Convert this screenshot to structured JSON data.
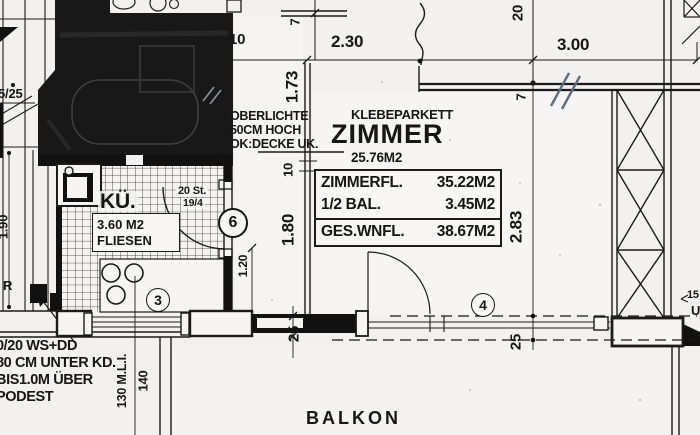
{
  "colors": {
    "ink": "#1b1b1b",
    "paper": "#f2f1ef",
    "pencil_blue": "#5d6c80"
  },
  "rooms": {
    "zimmer": {
      "name": "ZIMMER",
      "area": "25.76M2",
      "floor": "KLEBEPARKETT"
    },
    "kueche": {
      "name": "KÜ.",
      "area": "3.60 M2",
      "floor": "FLIESEN"
    },
    "balkon": {
      "name": "BALKON"
    }
  },
  "notes": {
    "oberlichte": [
      "OBERLICHTE",
      "50CM HOCH",
      "OK:DECKE UK."
    ],
    "shaft": [
      "0/20 WS+DD",
      "80 CM UNTER KD.",
      "BIS1.0M ÜBER",
      "PODEST"
    ],
    "stair_steps": "20 St.",
    "stair_ratio": "19/4"
  },
  "area_table": {
    "rows": [
      {
        "label": "ZIMMERFL.",
        "value": "35.22M2"
      },
      {
        "label": "1/2 BAL.",
        "value": "3.45M2"
      },
      {
        "label": "GES.WNFL.",
        "value": "38.67M2"
      }
    ]
  },
  "dims": {
    "w10_top": "10",
    "h7_top": "7",
    "w230": "2.30",
    "h173": "1.73",
    "h20": "20",
    "w300": "3.00",
    "h7_right": "7",
    "h283": "2.83",
    "h10_mid": "10",
    "h180": "1.80",
    "h120": "1.20",
    "h25_left": "25",
    "h25_right": "25",
    "h190": "1.90",
    "stair": "5/25",
    "sill_left": "130 M.L.I.",
    "sill_right": "140",
    "w15": "15",
    "u": "U",
    "r": "R"
  },
  "positions": {
    "p3": "3",
    "p4": "4",
    "p6": "6"
  }
}
